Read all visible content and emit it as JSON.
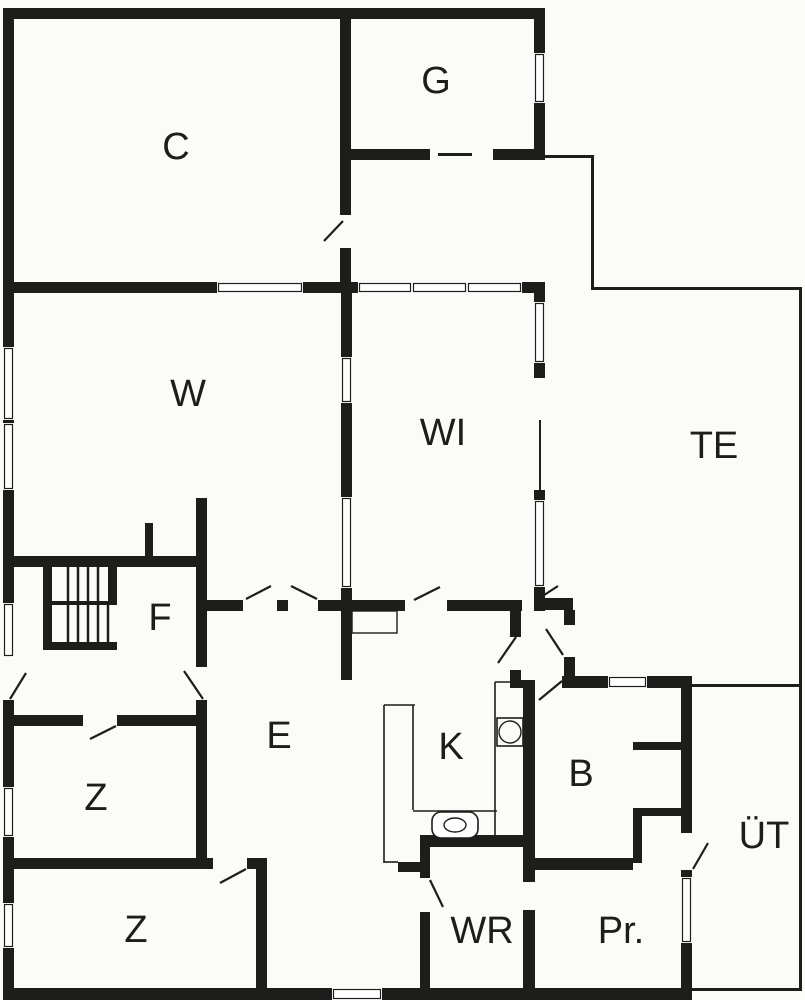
{
  "plan": {
    "title": "floor-plan",
    "width": 805,
    "height": 1000,
    "colors": {
      "background": "#fbfbf8",
      "wall": "#1d1d1b",
      "line": "#1d1d1b",
      "text": "#1d1d1b",
      "window_fill": "#ffffff"
    },
    "rooms": [
      {
        "id": "c",
        "label": "C",
        "x": 176,
        "y": 147
      },
      {
        "id": "g",
        "label": "G",
        "x": 436,
        "y": 81
      },
      {
        "id": "w",
        "label": "W",
        "x": 188,
        "y": 394
      },
      {
        "id": "wi",
        "label": "WI",
        "x": 443,
        "y": 433
      },
      {
        "id": "te",
        "label": "TE",
        "x": 714,
        "y": 446
      },
      {
        "id": "f",
        "label": "F",
        "x": 160,
        "y": 618
      },
      {
        "id": "e",
        "label": "E",
        "x": 279,
        "y": 736
      },
      {
        "id": "z1",
        "label": "Z",
        "x": 96,
        "y": 798
      },
      {
        "id": "z2",
        "label": "Z",
        "x": 136,
        "y": 930
      },
      {
        "id": "k",
        "label": "K",
        "x": 451,
        "y": 747
      },
      {
        "id": "b",
        "label": "B",
        "x": 581,
        "y": 774
      },
      {
        "id": "wr",
        "label": "WR",
        "x": 482,
        "y": 931
      },
      {
        "id": "pr",
        "label": "Pr.",
        "x": 621,
        "y": 931
      },
      {
        "id": "ut",
        "label": "ÜT",
        "x": 764,
        "y": 836
      }
    ],
    "label_font_size": 38,
    "walls": [
      [
        3,
        8,
        542,
        11
      ],
      [
        3,
        8,
        11,
        992
      ],
      [
        340,
        8,
        11,
        284
      ],
      [
        534,
        8,
        11,
        152
      ],
      [
        346,
        149,
        199,
        11
      ],
      [
        3,
        282,
        542,
        11
      ],
      [
        534,
        282,
        11,
        96
      ],
      [
        534,
        490,
        11,
        121
      ],
      [
        341,
        282,
        11,
        398
      ],
      [
        3,
        556,
        204,
        11
      ],
      [
        145,
        523,
        8,
        33
      ],
      [
        196,
        498,
        11,
        365
      ],
      [
        3,
        715,
        204,
        11
      ],
      [
        3,
        858,
        264,
        11
      ],
      [
        256,
        858,
        11,
        142
      ],
      [
        3,
        988,
        689,
        12
      ],
      [
        196,
        600,
        326,
        11
      ],
      [
        537,
        598,
        36,
        12
      ],
      [
        510,
        608,
        11,
        29
      ],
      [
        510,
        670,
        11,
        10
      ],
      [
        510,
        680,
        25,
        8
      ],
      [
        564,
        610,
        11,
        15
      ],
      [
        564,
        657,
        11,
        23
      ],
      [
        562,
        676,
        130,
        12
      ],
      [
        681,
        676,
        11,
        157
      ],
      [
        681,
        870,
        11,
        120
      ],
      [
        633,
        742,
        48,
        8
      ],
      [
        633,
        808,
        48,
        8
      ],
      [
        633,
        808,
        9,
        55
      ],
      [
        527,
        858,
        106,
        12
      ],
      [
        523,
        680,
        12,
        310
      ],
      [
        420,
        835,
        115,
        12
      ],
      [
        420,
        847,
        10,
        141
      ],
      [
        398,
        862,
        22,
        10
      ]
    ],
    "gaps": [
      [
        3,
        657,
        11,
        43
      ],
      [
        340,
        215,
        11,
        33
      ],
      [
        430,
        149,
        63,
        11
      ],
      [
        196,
        667,
        11,
        33
      ],
      [
        83,
        715,
        34,
        11
      ],
      [
        213,
        858,
        34,
        11
      ],
      [
        243,
        600,
        34,
        11
      ],
      [
        288,
        600,
        30,
        11
      ],
      [
        405,
        600,
        42,
        11
      ],
      [
        523,
        882,
        12,
        28
      ],
      [
        420,
        878,
        10,
        34
      ]
    ],
    "windows": [
      [
        217,
        282,
        86,
        11
      ],
      [
        358,
        282,
        54,
        11
      ],
      [
        412,
        282,
        55,
        11
      ],
      [
        467,
        282,
        55,
        11
      ],
      [
        332,
        988,
        50,
        12
      ],
      [
        608,
        676,
        39,
        12
      ],
      [
        534,
        53,
        11,
        50
      ],
      [
        534,
        302,
        11,
        61
      ],
      [
        534,
        500,
        11,
        87
      ],
      [
        3,
        347,
        11,
        73
      ],
      [
        3,
        423,
        11,
        67
      ],
      [
        3,
        603,
        11,
        54
      ],
      [
        3,
        787,
        11,
        50
      ],
      [
        3,
        903,
        11,
        45
      ],
      [
        341,
        357,
        11,
        46
      ],
      [
        341,
        497,
        11,
        91
      ],
      [
        681,
        877,
        11,
        66
      ]
    ],
    "thin_lines": [
      [
        545,
        155,
        48,
        3
      ],
      [
        591,
        155,
        3,
        134
      ],
      [
        591,
        287,
        211,
        3
      ],
      [
        799,
        287,
        3,
        703
      ],
      [
        692,
        684,
        110,
        3
      ],
      [
        692,
        988,
        110,
        3
      ],
      [
        539,
        420,
        2,
        70
      ],
      [
        438,
        153,
        34,
        3
      ]
    ],
    "door_leaves": [
      [
        343,
        221,
        324,
        241
      ],
      [
        10,
        699,
        26,
        673
      ],
      [
        184,
        671,
        203,
        699
      ],
      [
        246,
        599,
        271,
        586
      ],
      [
        291,
        586,
        317,
        599
      ],
      [
        414,
        600,
        440,
        587
      ],
      [
        538,
        599,
        558,
        586
      ],
      [
        516,
        637,
        498,
        663
      ],
      [
        563,
        655,
        546,
        629
      ],
      [
        539,
        700,
        562,
        681
      ],
      [
        693,
        869,
        708,
        843
      ],
      [
        430,
        880,
        443,
        907
      ],
      [
        116,
        726,
        90,
        739
      ],
      [
        246,
        869,
        220,
        883
      ]
    ],
    "stairs": {
      "bars": [
        [
          43,
          565,
          9,
          85
        ],
        [
          43,
          642,
          74,
          8
        ],
        [
          108,
          565,
          9,
          40
        ],
        [
          52,
          601,
          65,
          4
        ]
      ],
      "treads_upper": {
        "xs": [
          68,
          78,
          88,
          98
        ],
        "y1": 567,
        "y2": 601
      },
      "treads_lower": {
        "xs": [
          68,
          78,
          88,
          98,
          108
        ],
        "y1": 605,
        "y2": 642
      }
    },
    "kitchen": {
      "counter_lines": [
        [
          384,
          705,
          384,
          863
        ],
        [
          384,
          705,
          415,
          705
        ],
        [
          413,
          705,
          413,
          810
        ],
        [
          384,
          862,
          398,
          862
        ],
        [
          413,
          811,
          497,
          811
        ],
        [
          495,
          682,
          495,
          837
        ],
        [
          495,
          682,
          525,
          682
        ]
      ],
      "stove": {
        "x": 497,
        "y": 718,
        "w": 26,
        "h": 28,
        "cx": 510,
        "cy": 732,
        "r": 11
      },
      "sink": {
        "x": 432,
        "y": 812,
        "w": 46,
        "h": 26,
        "rx": 9,
        "cx": 455,
        "cy": 825,
        "ex": 11,
        "ey": 7
      }
    },
    "closet": [
      352,
      611,
      45,
      22
    ]
  }
}
